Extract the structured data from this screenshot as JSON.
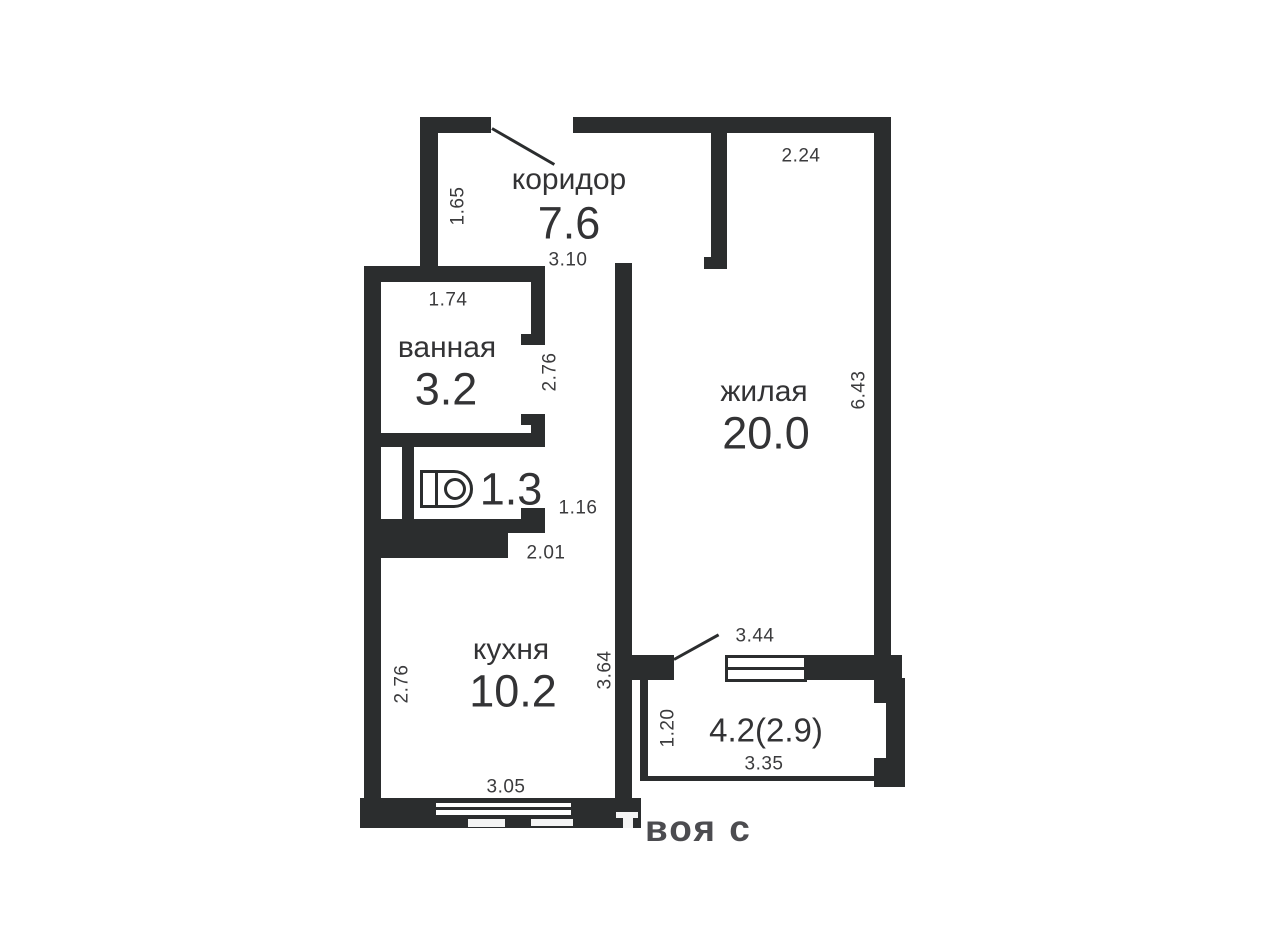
{
  "plan": {
    "rooms": [
      {
        "id": "corridor",
        "name": "коридор",
        "area": "7.6"
      },
      {
        "id": "bathroom",
        "name": "ванная",
        "area": "3.2"
      },
      {
        "id": "toilet",
        "name": "",
        "area": "1.3"
      },
      {
        "id": "kitchen",
        "name": "кухня",
        "area": "10.2"
      },
      {
        "id": "living",
        "name": "жилая",
        "area": "20.0"
      },
      {
        "id": "balcony",
        "name": "",
        "area": "4.2(2.9)"
      }
    ],
    "dimensions": {
      "corridor_left": "1.65",
      "corridor_width": "3.10",
      "living_top": "2.24",
      "bath_width": "1.74",
      "bath_right": "2.76",
      "toilet_door": "1.16",
      "kitchen_doorway": "2.01",
      "kitchen_left": "2.76",
      "kitchen_right": "3.64",
      "kitchen_bottom": "3.05",
      "living_right": "6.43",
      "living_width": "3.44",
      "balcony_height": "1.20",
      "balcony_width": "3.35"
    },
    "icons": {
      "toilet": "toilet-icon"
    },
    "watermark": "воя с",
    "colors": {
      "wall": "#2b2d2e",
      "text": "#3b3b3d",
      "background": "#ffffff"
    }
  }
}
